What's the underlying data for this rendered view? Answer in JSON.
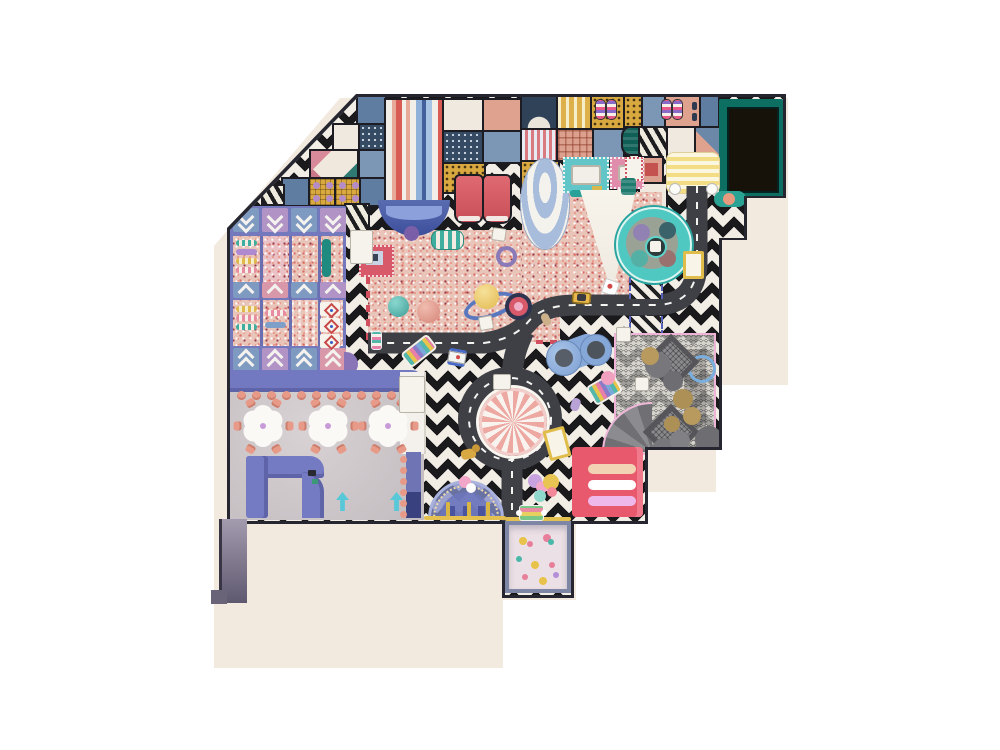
{
  "scene": {
    "type": "indoor-playground-floor-plan-top-view",
    "palette": {
      "backdrop": "#ffffff",
      "beige_shadow": "#f2e9df",
      "wall": "#262630",
      "zigzag_dark": "#1a1a1d",
      "zigzag_light": "#f2eee6",
      "ball_pit": "#e9c4b8",
      "road": "#3f4046",
      "road_line": "#f4f4f2",
      "frame_purple": "#7479bd",
      "salmon": "#e89a88",
      "cafe_floor": "#cac2c5",
      "wheel_teal": "#4fc8c2",
      "parasol_pink": "#eda8a2",
      "slide_red": "#d85b54",
      "pink_block": "#e8596e",
      "dark_room": "#171209",
      "dark_room_frame": "#0d6e62",
      "arch_blue": "#8a94c8",
      "fence_yellow": "#e3c050",
      "net_pink_border": "#efb3d7"
    },
    "counts": {
      "cafe_tables": 3,
      "chairs_per_table": 6,
      "bench_stools": 12,
      "yellow_fence_posts": 3,
      "wheel_pods": 4
    }
  },
  "block_tiles": [
    [
      358,
      97,
      27,
      30,
      "blue1"
    ],
    [
      334,
      125,
      24,
      28,
      "cream"
    ],
    [
      360,
      125,
      25,
      28,
      "dots"
    ],
    [
      311,
      151,
      46,
      27,
      "tri"
    ],
    [
      360,
      151,
      25,
      27,
      "blue2"
    ],
    [
      283,
      179,
      25,
      26,
      "blue1"
    ],
    [
      310,
      179,
      24,
      26,
      "mgridp"
    ],
    [
      336,
      179,
      23,
      26,
      "mgridp"
    ],
    [
      361,
      179,
      24,
      26,
      "blue1"
    ],
    [
      263,
      186,
      20,
      18,
      "zebra"
    ],
    [
      346,
      205,
      22,
      26,
      "zebra"
    ],
    [
      444,
      100,
      38,
      30,
      "cream"
    ],
    [
      484,
      100,
      36,
      30,
      "salmon"
    ],
    [
      444,
      132,
      38,
      30,
      "dots"
    ],
    [
      484,
      132,
      36,
      30,
      "blue2"
    ],
    [
      444,
      164,
      40,
      28,
      "mdots"
    ],
    [
      522,
      97,
      34,
      31,
      "halfmoon"
    ],
    [
      558,
      97,
      32,
      31,
      "slats"
    ],
    [
      592,
      97,
      31,
      31,
      "mdots"
    ],
    [
      625,
      97,
      16,
      29,
      "mdots"
    ],
    [
      643,
      97,
      21,
      29,
      "blue2"
    ],
    [
      666,
      97,
      33,
      31,
      "salmon"
    ],
    [
      701,
      97,
      17,
      31,
      "blue1"
    ],
    [
      522,
      130,
      34,
      30,
      "pstripes"
    ],
    [
      558,
      130,
      34,
      30,
      "cross"
    ],
    [
      594,
      130,
      29,
      30,
      "blue2"
    ],
    [
      623,
      128,
      30,
      26,
      "tealpill"
    ],
    [
      640,
      128,
      27,
      32,
      "zebra"
    ],
    [
      668,
      128,
      27,
      58,
      "cream"
    ],
    [
      696,
      128,
      23,
      32,
      "tri2"
    ],
    [
      522,
      162,
      36,
      30,
      "mdots"
    ],
    [
      640,
      158,
      22,
      24,
      "reddoor"
    ],
    [
      640,
      184,
      26,
      26,
      "cream"
    ]
  ],
  "left_structure": {
    "chevron_rows": [
      {
        "y": 208,
        "h": 24,
        "double": true,
        "dir": "down",
        "colors": [
          "#7e9ac0",
          "#b293c6",
          "#7e9ac0",
          "#b293c6"
        ]
      },
      {
        "y": 282,
        "h": 16,
        "double": false,
        "dir": "up",
        "colors": [
          "#7e9ac0",
          "#d898aa",
          "#7e9ac0",
          "#b293c6"
        ]
      },
      {
        "y": 348,
        "h": 24,
        "double": true,
        "dir": "up",
        "colors": [
          "#7e9ac0",
          "#b293c6",
          "#7e9ac0",
          "#d898aa"
        ]
      }
    ],
    "bars": [
      [
        236,
        240,
        "b-teal"
      ],
      [
        236,
        249,
        "b-purple"
      ],
      [
        236,
        258,
        "b-mustard"
      ],
      [
        236,
        267,
        "b-pink"
      ],
      [
        236,
        306,
        "b-mustard"
      ],
      [
        236,
        315,
        "b-pink"
      ],
      [
        236,
        324,
        "b-teal"
      ],
      [
        265,
        310,
        "b-pink"
      ],
      [
        265,
        322,
        "b-blue"
      ]
    ],
    "diamond_tiles": [
      [
        320,
        302
      ],
      [
        320,
        318
      ],
      [
        320,
        334
      ]
    ]
  },
  "cafe": {
    "tables": [
      [
        263,
        426
      ],
      [
        328,
        426
      ],
      [
        388,
        426
      ]
    ],
    "chair_radius": 26,
    "stools_x": [
      237,
      252,
      267,
      282,
      297,
      312,
      327,
      342,
      357,
      372,
      387,
      402
    ],
    "stool_y": 391,
    "arrows": [
      [
        336,
        492
      ],
      [
        390,
        492
      ]
    ],
    "wall_dots_y": [
      456,
      467,
      478,
      489,
      500,
      511
    ]
  },
  "deco": [
    {
      "n": "police-car",
      "x": 448,
      "y": 349,
      "w": 18,
      "h": 11,
      "rot": 10,
      "cls": "car-police"
    },
    {
      "n": "yellow-car",
      "x": 572,
      "y": 292,
      "w": 19,
      "h": 12,
      "rot": 4,
      "cls": "car-yellow"
    },
    {
      "n": "toy-scooter",
      "x": 542,
      "y": 313,
      "w": 8,
      "h": 13,
      "rot": -25,
      "cls": "scooter"
    },
    {
      "n": "pink-cart",
      "x": 371,
      "y": 331,
      "w": 9,
      "h": 17,
      "rot": 0,
      "cls": "cart-pink"
    },
    {
      "n": "rainbow-ladder",
      "x": 402,
      "y": 342,
      "w": 30,
      "h": 14,
      "rot": -38,
      "cls": "rainbow"
    },
    {
      "n": "rainbow-ladder",
      "x": 589,
      "y": 378,
      "w": 27,
      "h": 18,
      "rot": -30,
      "cls": "rainbow"
    },
    {
      "n": "lavender-scooter",
      "x": 571,
      "y": 398,
      "w": 9,
      "h": 13,
      "rot": 18,
      "cls": "scooter-lav"
    },
    {
      "n": "toll-gate",
      "x": 683,
      "y": 251,
      "w": 15,
      "h": 22,
      "rot": 0,
      "cls": "gate"
    },
    {
      "n": "toll-gate",
      "x": 546,
      "y": 428,
      "w": 16,
      "h": 25,
      "rot": -15,
      "cls": "gate"
    },
    {
      "n": "rainbow-booth",
      "x": 519,
      "y": 505,
      "w": 23,
      "h": 14,
      "rot": 0,
      "cls": "booth"
    },
    {
      "n": "toy-dog",
      "x": 461,
      "y": 449,
      "w": 15,
      "h": 10,
      "rot": -12,
      "cls": "dog"
    },
    {
      "n": "striped-drum",
      "x": 431,
      "y": 230,
      "w": 31,
      "h": 18,
      "rot": 0,
      "cls": "drum"
    },
    {
      "n": "teal-ball",
      "x": 388,
      "y": 296,
      "w": 21,
      "h": 21,
      "cls": "ball-teal"
    },
    {
      "n": "salmon-ball",
      "x": 417,
      "y": 300,
      "w": 23,
      "h": 23,
      "cls": "ball-salmon"
    },
    {
      "n": "saturn-ring",
      "x": 463,
      "y": 294,
      "w": 46,
      "h": 16,
      "rot": -18,
      "cls": "saturn-ring"
    },
    {
      "n": "saturn-ball",
      "x": 474,
      "y": 284,
      "w": 25,
      "h": 25,
      "cls": "saturn-ball"
    },
    {
      "n": "purple-ring",
      "x": 496,
      "y": 246,
      "w": 13,
      "h": 13,
      "rot": 15,
      "cls": "ring-purple"
    },
    {
      "n": "red-ring-toy",
      "x": 505,
      "y": 293,
      "w": 27,
      "h": 27,
      "cls": "ring-red"
    },
    {
      "n": "white-pad",
      "x": 492,
      "y": 228,
      "w": 12,
      "h": 11,
      "rot": 8,
      "cls": "pad-white"
    },
    {
      "n": "white-pad",
      "x": 479,
      "y": 316,
      "w": 12,
      "h": 12,
      "rot": -10,
      "cls": "pad-white"
    },
    {
      "n": "white-pad",
      "x": 493,
      "y": 374,
      "w": 16,
      "h": 14,
      "cls": "pad-white"
    },
    {
      "n": "white-pad",
      "x": 616,
      "y": 327,
      "w": 13,
      "h": 13,
      "cls": "pad-white"
    },
    {
      "n": "white-pad",
      "x": 635,
      "y": 377,
      "w": 12,
      "h": 12,
      "cls": "pad-white"
    },
    {
      "n": "white-mat",
      "x": 350,
      "y": 230,
      "w": 21,
      "h": 32,
      "cls": "pad-white"
    },
    {
      "n": "station-pad",
      "x": 399,
      "y": 376,
      "w": 24,
      "h": 35,
      "cls": "pad-white"
    },
    {
      "n": "red-mini-pad",
      "x": 625,
      "y": 157,
      "w": 14,
      "h": 20,
      "cls": "pad-red"
    },
    {
      "n": "candy-roller",
      "x": 596,
      "y": 100,
      "w": 9,
      "h": 19,
      "cls": "roller"
    },
    {
      "n": "candy-roller",
      "x": 607,
      "y": 100,
      "w": 9,
      "h": 19,
      "cls": "roller"
    },
    {
      "n": "candy-roller",
      "x": 662,
      "y": 100,
      "w": 9,
      "h": 19,
      "cls": "roller"
    },
    {
      "n": "candy-roller",
      "x": 673,
      "y": 100,
      "w": 9,
      "h": 19,
      "cls": "roller"
    },
    {
      "n": "knob",
      "x": 692,
      "y": 102,
      "w": 5,
      "h": 8,
      "cls": "knob"
    },
    {
      "n": "knob",
      "x": 692,
      "y": 113,
      "w": 5,
      "h": 8,
      "cls": "knob"
    },
    {
      "n": "road-post",
      "x": 670,
      "y": 184,
      "w": 10,
      "h": 10,
      "cls": "post"
    },
    {
      "n": "road-post",
      "x": 707,
      "y": 184,
      "w": 10,
      "h": 10,
      "cls": "post"
    },
    {
      "n": "teal-block",
      "x": 621,
      "y": 178,
      "w": 15,
      "h": 17,
      "cls": "tealblock"
    },
    {
      "n": "net-diamond-pad",
      "x": 651,
      "y": 342,
      "w": 30,
      "h": 30,
      "cls": "diamond-pad"
    },
    {
      "n": "net-diamond-pad",
      "x": 651,
      "y": 412,
      "w": 30,
      "h": 30,
      "cls": "diamond-pad"
    }
  ],
  "net_circles": [
    {
      "x": 645,
      "y": 352,
      "r": 13,
      "bg": "#77777c"
    },
    {
      "x": 663,
      "y": 371,
      "r": 10,
      "bg": "#6d6d72"
    },
    {
      "x": 652,
      "y": 438,
      "r": 12,
      "bg": "#77777c"
    },
    {
      "x": 695,
      "y": 426,
      "r": 14,
      "bg": "#6d6d72"
    },
    {
      "x": 670,
      "y": 431,
      "r": 10,
      "bg": "#808085"
    },
    {
      "x": 641,
      "y": 347,
      "r": 9,
      "bg": "#b89a5e"
    },
    {
      "x": 673,
      "y": 389,
      "r": 10,
      "bg": "#ad9055"
    },
    {
      "x": 683,
      "y": 407,
      "r": 9,
      "bg": "#b89a5e"
    },
    {
      "x": 664,
      "y": 416,
      "r": 8,
      "bg": "#ad9055"
    }
  ],
  "balloons": [
    {
      "x": 528,
      "y": 474,
      "r": 7,
      "bg": "#c9a3e0"
    },
    {
      "x": 536,
      "y": 481,
      "r": 6,
      "bg": "#f2a6c8"
    },
    {
      "x": 543,
      "y": 474,
      "r": 8,
      "bg": "#e8c452"
    },
    {
      "x": 534,
      "y": 490,
      "r": 6,
      "bg": "#8fd8cc"
    },
    {
      "x": 547,
      "y": 487,
      "r": 5,
      "bg": "#f2889a"
    },
    {
      "x": 601,
      "y": 371,
      "r": 7,
      "bg": "#f2a0c0"
    },
    {
      "x": 459,
      "y": 476,
      "r": 6,
      "bg": "#f2a6c8"
    },
    {
      "x": 466,
      "y": 483,
      "r": 5,
      "bg": "#fdfdfd"
    }
  ],
  "toddler_toys": [
    {
      "x": 519,
      "y": 537,
      "r": 4,
      "bg": "#e8c24a"
    },
    {
      "x": 527,
      "y": 541,
      "r": 3,
      "bg": "#e87f9a"
    },
    {
      "x": 543,
      "y": 534,
      "r": 4,
      "bg": "#e87f9a"
    },
    {
      "x": 548,
      "y": 539,
      "r": 3,
      "bg": "#49b8a8"
    },
    {
      "x": 516,
      "y": 556,
      "r": 3,
      "bg": "#49b8a8"
    },
    {
      "x": 531,
      "y": 561,
      "r": 4,
      "bg": "#e8c24a"
    },
    {
      "x": 549,
      "y": 562,
      "r": 3,
      "bg": "#e87f9a"
    },
    {
      "x": 522,
      "y": 574,
      "r": 3,
      "bg": "#e87f9a"
    },
    {
      "x": 539,
      "y": 577,
      "r": 4,
      "bg": "#e8c24a"
    },
    {
      "x": 553,
      "y": 572,
      "r": 3,
      "bg": "#b48ed8"
    }
  ]
}
